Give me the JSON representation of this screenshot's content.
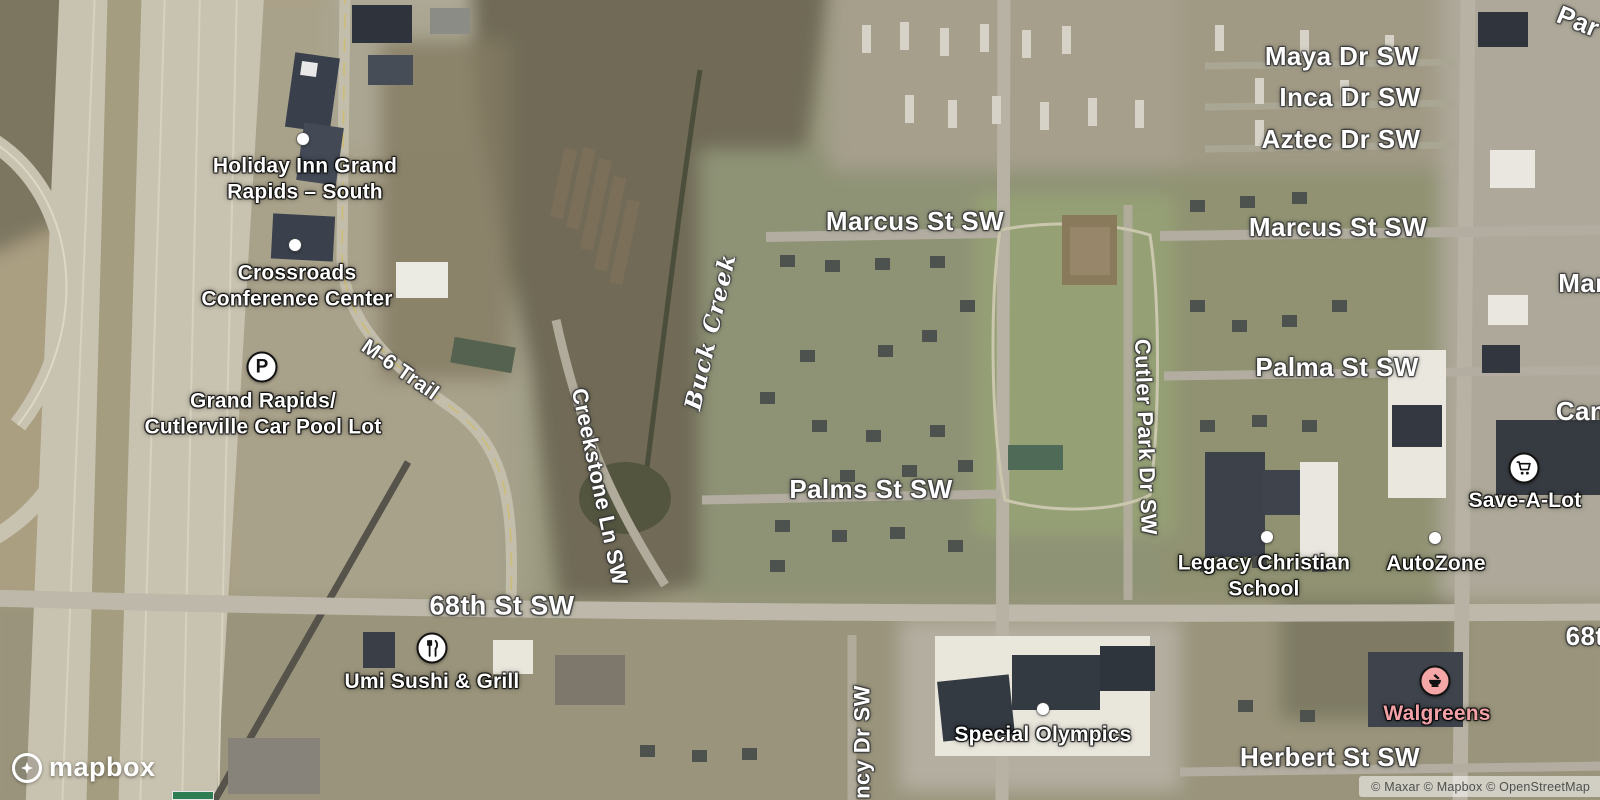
{
  "map": {
    "logo_text": "mapbox",
    "attribution": "© Maxar © Mapbox © OpenStreetMap",
    "colors": {
      "walgreens_pink": "#f2a2a7",
      "marker_border": "#121212",
      "label_white": "#ffffff",
      "park_green": "#95a075",
      "highway_pavement": "#c8c2b0"
    },
    "labels": [
      {
        "name": "label-maya-dr-sw",
        "type": "road",
        "text": "Maya Dr SW",
        "x": 1342,
        "y": 57,
        "size": 26
      },
      {
        "name": "label-inca-dr-sw",
        "type": "road",
        "text": "Inca Dr SW",
        "x": 1350,
        "y": 98,
        "size": 26
      },
      {
        "name": "label-aztec-dr-sw",
        "type": "road",
        "text": "Aztec Dr SW",
        "x": 1341,
        "y": 140,
        "size": 26
      },
      {
        "name": "label-marcus-st-sw-center",
        "type": "road",
        "text": "Marcus St SW",
        "x": 915,
        "y": 222,
        "size": 26
      },
      {
        "name": "label-marcus-st-sw-right",
        "type": "road",
        "text": "Marcus St SW",
        "x": 1338,
        "y": 228,
        "size": 26
      },
      {
        "name": "label-palma-st-sw",
        "type": "road",
        "text": "Palma St SW",
        "x": 1337,
        "y": 368,
        "size": 26
      },
      {
        "name": "label-palms-st-sw",
        "type": "road",
        "text": "Palms St SW",
        "x": 871,
        "y": 490,
        "size": 26
      },
      {
        "name": "label-68th-st-sw",
        "type": "road",
        "text": "68th St SW",
        "x": 502,
        "y": 606,
        "size": 27
      },
      {
        "name": "label-herbert-st-sw",
        "type": "road",
        "text": "Herbert St SW",
        "x": 1330,
        "y": 758,
        "size": 26
      },
      {
        "name": "label-creekstone-ln-sw",
        "type": "road",
        "text": "Creekstone Ln SW",
        "x": 599,
        "y": 487,
        "size": 22,
        "rotate": 78
      },
      {
        "name": "label-cutler-park-dr-sw",
        "type": "road",
        "text": "Cutler Park Dr SW",
        "x": 1145,
        "y": 437,
        "size": 22,
        "rotate": 88
      },
      {
        "name": "label-m6-trail",
        "type": "road",
        "text": "M-6 Trail",
        "x": 400,
        "y": 370,
        "size": 21,
        "rotate": 35
      },
      {
        "name": "label-quincy-dr-sw-partial",
        "type": "road",
        "text": "ncy Dr SW",
        "x": 863,
        "y": 742,
        "size": 22,
        "rotate": -90
      },
      {
        "name": "label-buck-creek",
        "type": "water",
        "text": "Buck Creek",
        "x": 711,
        "y": 332,
        "size": 23,
        "rotate": -77
      },
      {
        "name": "label-68th-st-sw-partial-right",
        "type": "partial",
        "text": "68t",
        "x": 1585,
        "y": 637,
        "size": 26
      },
      {
        "name": "label-par-partial",
        "type": "partial",
        "text": "Par",
        "x": 1578,
        "y": 22,
        "size": 26,
        "rotate": 22
      },
      {
        "name": "label-mar-partial",
        "type": "partial",
        "text": "Mar",
        "x": 1582,
        "y": 284,
        "size": 26
      },
      {
        "name": "label-can-partial",
        "type": "partial",
        "text": "Can",
        "x": 1581,
        "y": 412,
        "size": 26
      },
      {
        "name": "label-holiday-inn",
        "type": "poi",
        "lines": [
          "Holiday Inn Grand",
          "Rapids – South"
        ],
        "x": 305,
        "y": 179,
        "size": 21
      },
      {
        "name": "label-crossroads-conference-center",
        "type": "poi",
        "lines": [
          "Crossroads",
          "Conference Center"
        ],
        "x": 297,
        "y": 286,
        "size": 21
      },
      {
        "name": "label-car-pool-lot",
        "type": "poi",
        "lines": [
          "Grand Rapids/",
          "Cutlerville Car Pool Lot"
        ],
        "x": 263,
        "y": 414,
        "size": 21
      },
      {
        "name": "label-umi-sushi-grill",
        "type": "poi",
        "lines": [
          "Umi Sushi & Grill"
        ],
        "x": 432,
        "y": 682,
        "size": 21
      },
      {
        "name": "label-special-olympics",
        "type": "poi",
        "lines": [
          "Special Olympics"
        ],
        "x": 1043,
        "y": 735,
        "size": 21
      },
      {
        "name": "label-legacy-christian-school",
        "type": "poi",
        "lines": [
          "Legacy Christian",
          "School"
        ],
        "x": 1264,
        "y": 576,
        "size": 21
      },
      {
        "name": "label-save-a-lot",
        "type": "poi",
        "lines": [
          "Save-A-Lot"
        ],
        "x": 1525,
        "y": 501,
        "size": 21
      },
      {
        "name": "label-autozone",
        "type": "poi",
        "lines": [
          "AutoZone"
        ],
        "x": 1436,
        "y": 564,
        "size": 21
      },
      {
        "name": "label-walgreens",
        "type": "poi",
        "lines": [
          "Walgreens"
        ],
        "x": 1437,
        "y": 714,
        "size": 21,
        "color": "#f2a2a7"
      }
    ],
    "markers": [
      {
        "name": "holiday-inn-marker",
        "icon": "dot",
        "x": 303,
        "y": 139
      },
      {
        "name": "crossroads-marker",
        "icon": "dot",
        "x": 295,
        "y": 245
      },
      {
        "name": "legacy-school-marker",
        "icon": "dot",
        "x": 1267,
        "y": 537
      },
      {
        "name": "special-olympics-marker",
        "icon": "dot",
        "x": 1043,
        "y": 709
      },
      {
        "name": "autozone-marker",
        "icon": "dot",
        "x": 1435,
        "y": 538
      },
      {
        "name": "car-pool-parking-marker",
        "icon": "badge",
        "glyph": "P",
        "x": 262,
        "y": 367
      },
      {
        "name": "umi-restaurant-marker",
        "icon": "badge",
        "svg": "restaurant",
        "x": 432,
        "y": 648
      },
      {
        "name": "save-a-lot-grocery-marker",
        "icon": "badge",
        "svg": "grocery",
        "x": 1524,
        "y": 468
      },
      {
        "name": "walgreens-pharmacy-marker",
        "icon": "badge",
        "svg": "pharmacy",
        "x": 1435,
        "y": 681,
        "color": "#f5a6a6"
      }
    ]
  }
}
